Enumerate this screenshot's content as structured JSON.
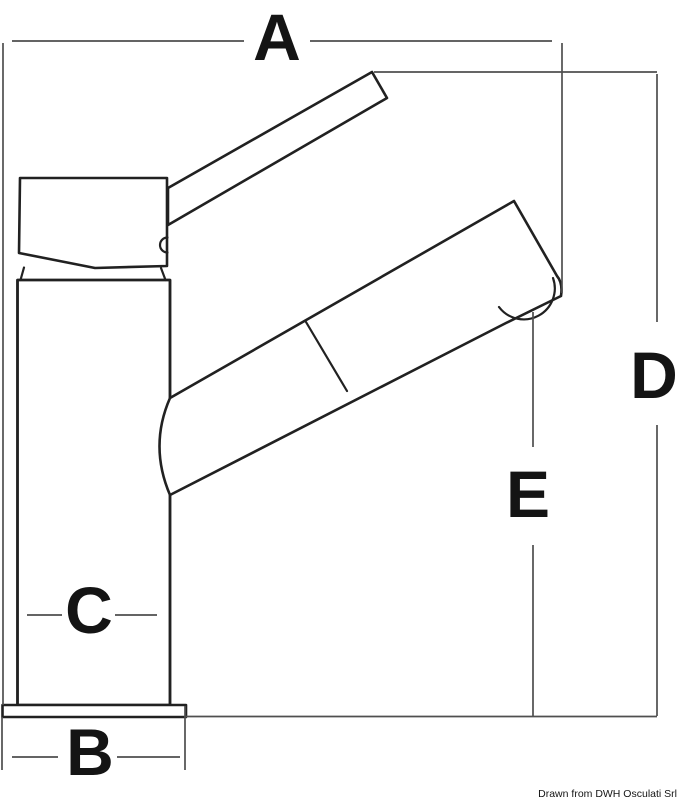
{
  "diagram": {
    "dimension_labels": {
      "a": "A",
      "b": "B",
      "c": "C",
      "d": "D",
      "e": "E"
    },
    "credit": "Drawn from DWH Osculati Srl",
    "colors": {
      "background": "#ffffff",
      "object_line": "#212121",
      "dimension_line": "#4f4f4f",
      "label_text": "#141414"
    }
  }
}
